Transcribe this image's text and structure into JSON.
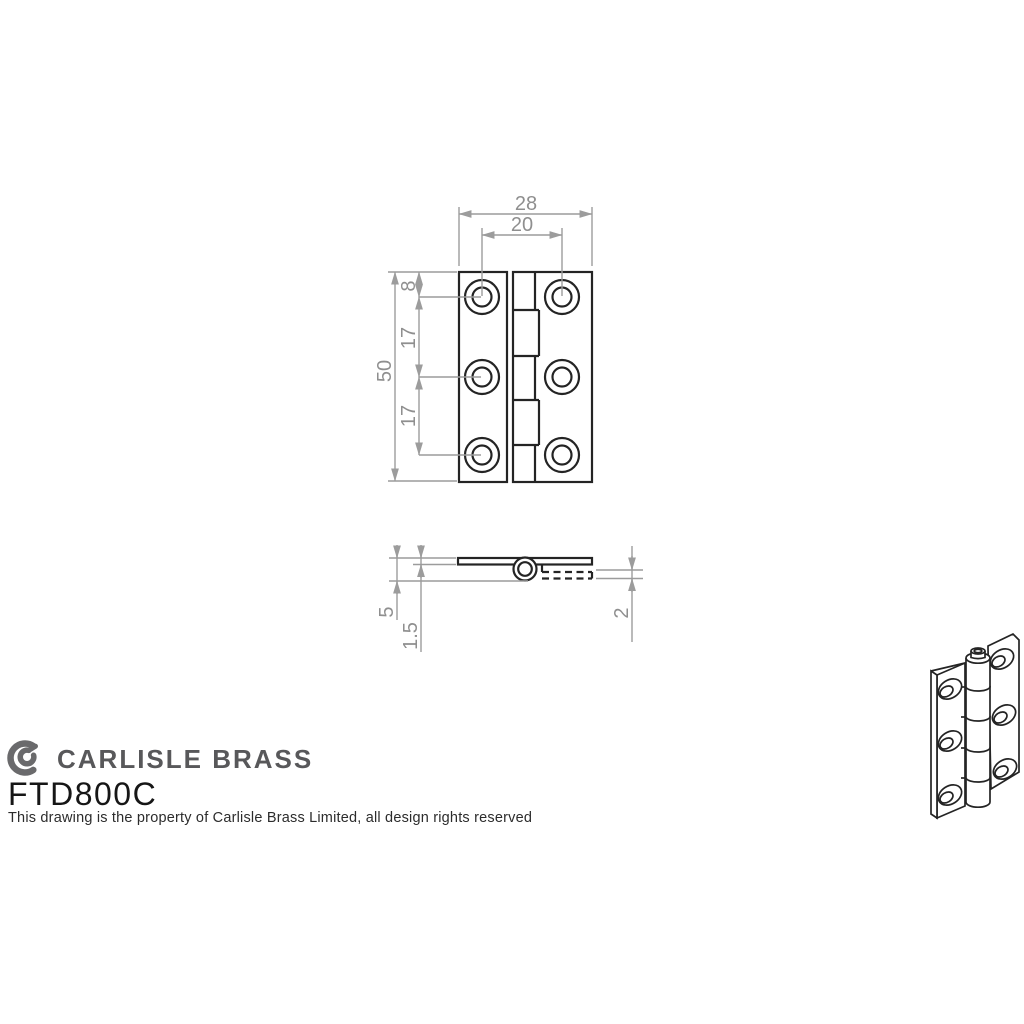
{
  "drawing": {
    "title": "Cabinet hinge technical drawing",
    "dims": {
      "width": "28",
      "hole_span": "20",
      "height": "50",
      "edge_to_hole": "8",
      "pitch_a": "17",
      "pitch_b": "17",
      "knuckle": "5",
      "leaf_thickness": "1.5",
      "leaf2_thickness": "2"
    }
  },
  "footer": {
    "brand": "CARLISLE BRASS",
    "product_code": "FTD800C",
    "rights_notice": "This drawing is the property of Carlisle Brass Limited, all design rights reserved"
  },
  "colors": {
    "drawing_line": "#242424",
    "dimension_line": "#9c9c9c",
    "dimension_text": "#8f8f8f",
    "logo_gray": "#6a6a6c",
    "brand_text": "#58585a",
    "code_text": "#161616",
    "notice_text": "#2c2c2c",
    "background": "#ffffff"
  }
}
